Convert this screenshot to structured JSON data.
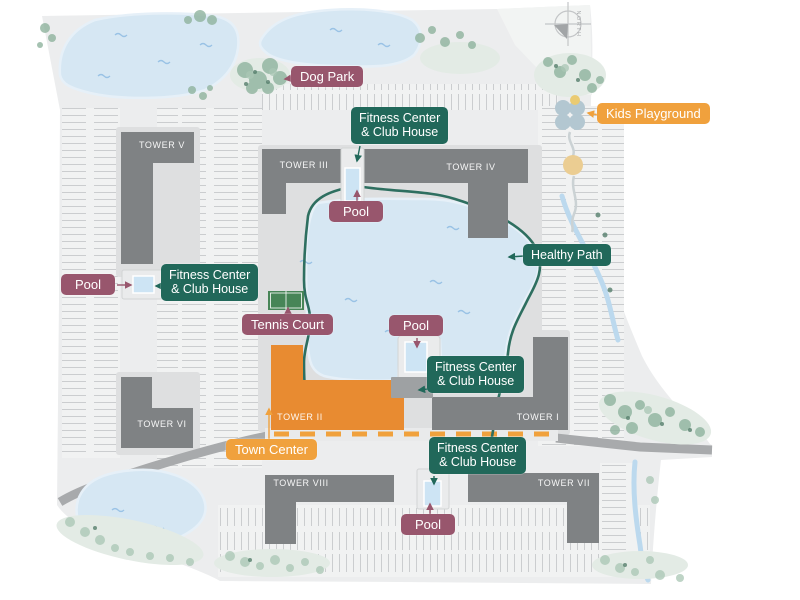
{
  "site_plan": {
    "compass_label": "NORTH",
    "towers": [
      {
        "label": "TOWER V"
      },
      {
        "label": "TOWER III"
      },
      {
        "label": "TOWER IV"
      },
      {
        "label": "TOWER VI"
      },
      {
        "label": "TOWER II"
      },
      {
        "label": "TOWER I"
      },
      {
        "label": "TOWER VIII"
      },
      {
        "label": "TOWER VII"
      }
    ],
    "labels": {
      "dog_park": "Dog Park",
      "kids_playground": "Kids Playground",
      "healthy_path": "Healthy Path",
      "tennis_court": "Tennis Court",
      "town_center": "Town Center",
      "pool": "Pool",
      "fitness_line1": "Fitness Center",
      "fitness_line2": "& Club House"
    },
    "colors": {
      "label_purple": "#98566D",
      "label_teal": "#21685A",
      "label_orange": "#F0A13D",
      "tower_gray": "#7F8284",
      "tower_orange": "#E88B31",
      "water": "#D6E7F3",
      "path_teal": "#2E6F60",
      "land": "#ECEDEE"
    }
  }
}
